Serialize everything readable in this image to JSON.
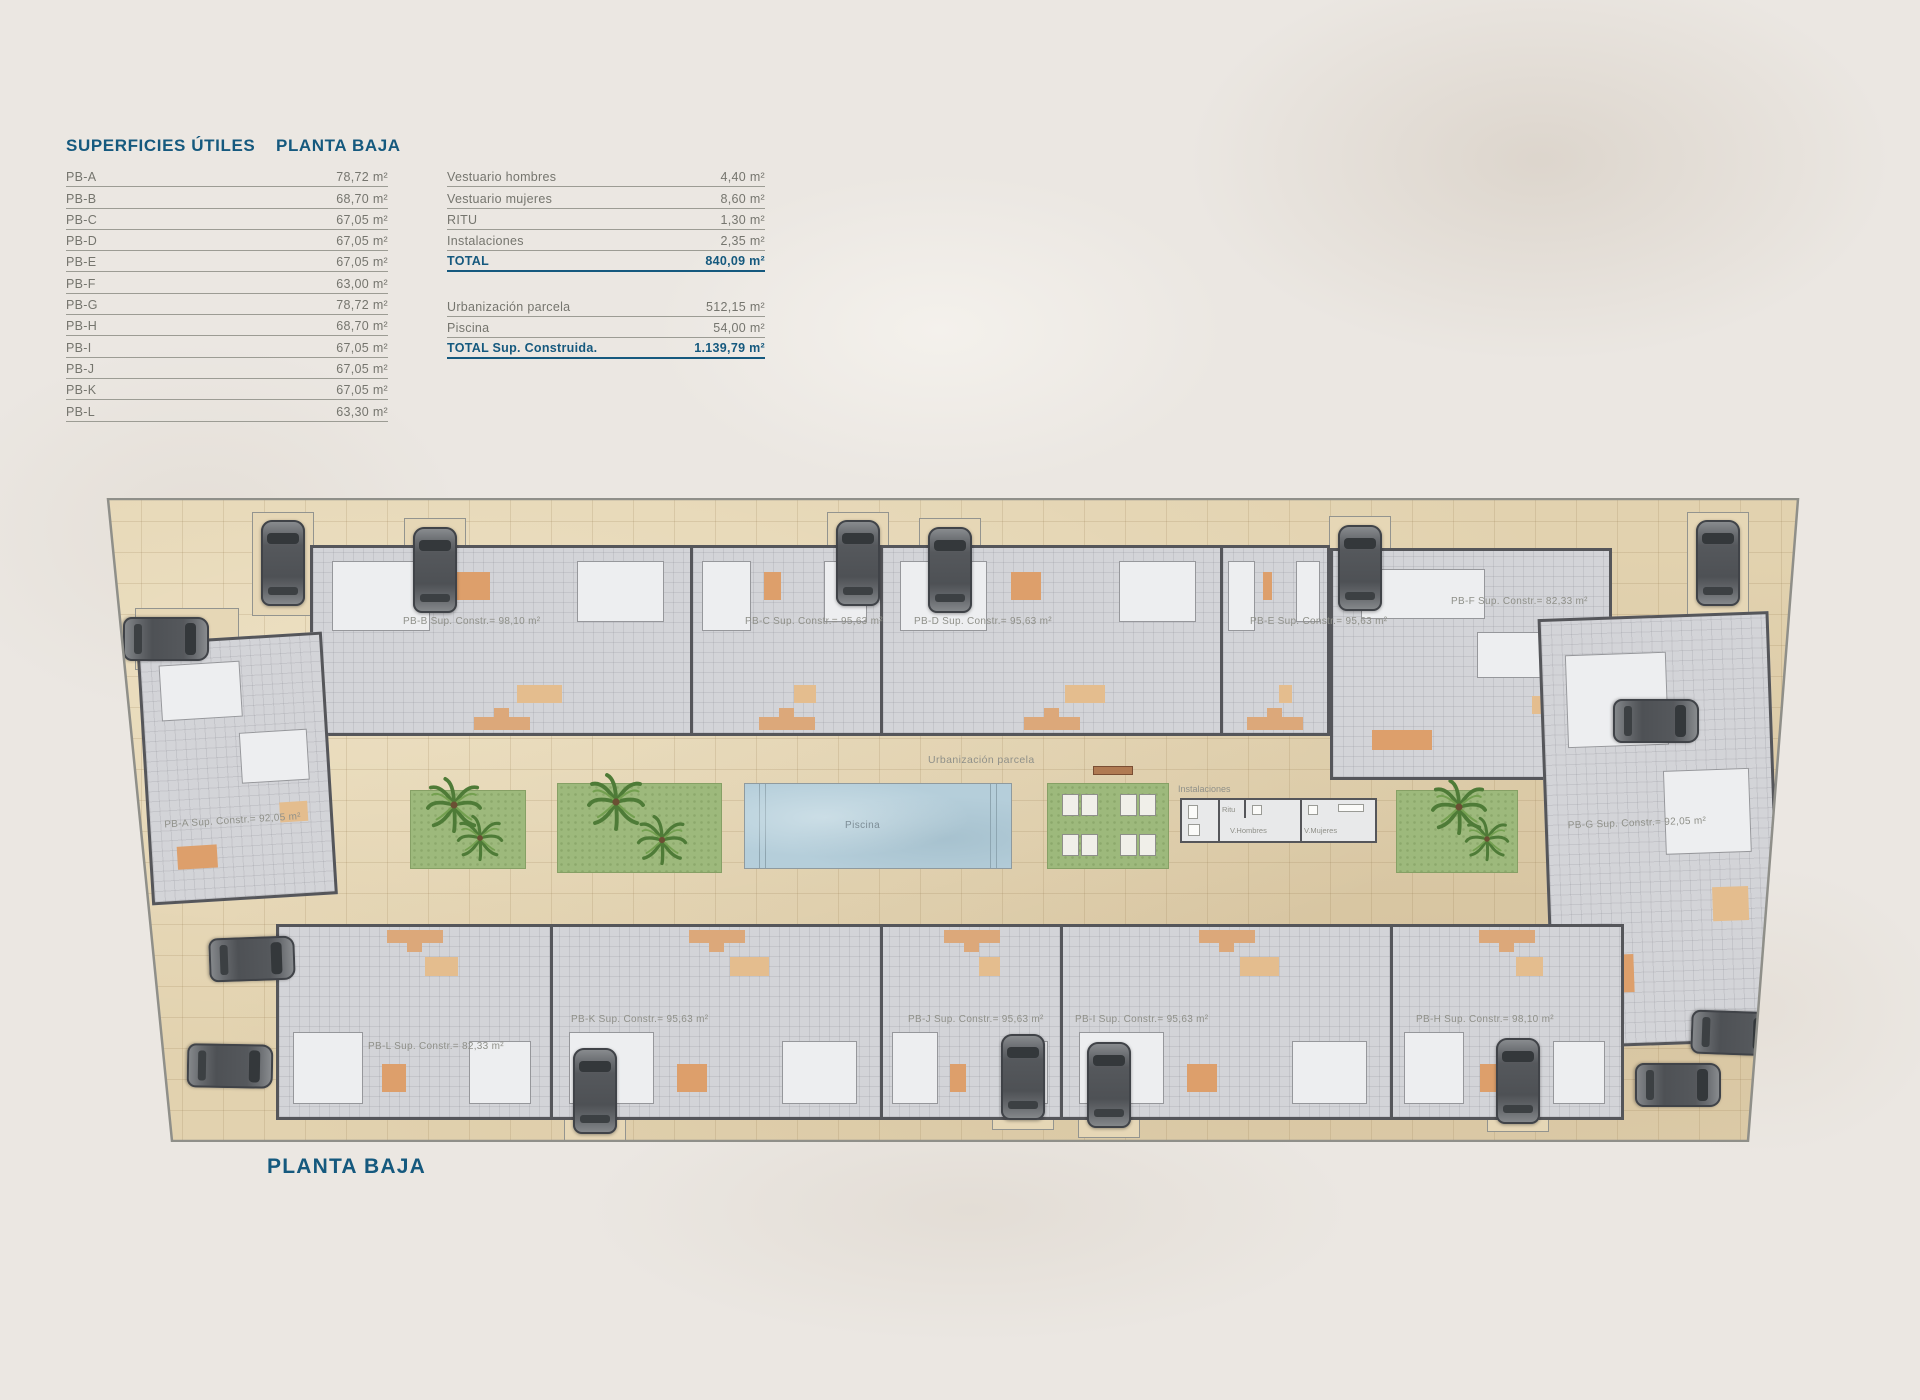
{
  "header": {
    "title": "SUPERFICIES ÚTILES",
    "subtitle": "PLANTA BAJA"
  },
  "areas_table": {
    "rows": [
      {
        "label": "PB-A",
        "value": "78,72 m²"
      },
      {
        "label": "PB-B",
        "value": "68,70 m²"
      },
      {
        "label": "PB-C",
        "value": "67,05 m²"
      },
      {
        "label": "PB-D",
        "value": "67,05 m²"
      },
      {
        "label": "PB-E",
        "value": "67,05 m²"
      },
      {
        "label": "PB-F",
        "value": "63,00 m²"
      },
      {
        "label": "PB-G",
        "value": "78,72 m²"
      },
      {
        "label": "PB-H",
        "value": "68,70 m²"
      },
      {
        "label": "PB-I",
        "value": "67,05 m²"
      },
      {
        "label": "PB-J",
        "value": "67,05 m²"
      },
      {
        "label": "PB-K",
        "value": "67,05 m²"
      },
      {
        "label": "PB-L",
        "value": "63,30 m²"
      }
    ]
  },
  "summary_table": {
    "rows": [
      {
        "label": "Vestuario hombres",
        "value": "4,40 m²"
      },
      {
        "label": "Vestuario mujeres",
        "value": "8,60 m²"
      },
      {
        "label": "RITU",
        "value": "1,30 m²"
      },
      {
        "label": "Instalaciones",
        "value": "2,35 m²"
      }
    ],
    "total": {
      "label": "TOTAL",
      "value": "840,09 m²"
    },
    "rows2": [
      {
        "label": "Urbanización parcela",
        "value": "512,15 m²"
      },
      {
        "label": "Piscina",
        "value": "54,00 m²"
      }
    ],
    "total2": {
      "label": "TOTAL Sup. Construida.",
      "value": "1.139,79 m²"
    }
  },
  "plan": {
    "units_top": [
      "PB-B Sup. Constr.= 98,10 m²",
      "PB-C Sup. Constr.= 95,63 m²",
      "PB-D Sup. Constr.= 95,63 m²",
      "PB-E Sup. Constr.= 95,63 m²"
    ],
    "unit_f": "PB-F Sup. Constr.= 82,33 m²",
    "unit_a": "PB-A Sup. Constr.= 92,05 m²",
    "unit_g": "PB-G Sup. Constr.= 92,05 m²",
    "units_bottom": [
      "PB-L Sup. Constr.= 82,33 m²",
      "PB-K Sup. Constr.= 95,63 m²",
      "PB-J Sup. Constr.= 95,63 m²",
      "PB-I Sup. Constr.= 95,63 m²",
      "PB-H Sup. Constr.= 98,10 m²"
    ],
    "labels": {
      "urbanizacion": "Urbanización parcela",
      "piscina": "Piscina",
      "instalaciones": "Instalaciones",
      "ritu": "Ritu",
      "vestuario_hombres": "V.Hombres",
      "vestuario_mujeres": "V.Mujeres"
    }
  },
  "footer": {
    "title": "PLANTA BAJA"
  },
  "colors": {
    "accent": "#15597e",
    "text_gray": "#75756e",
    "paving": "#e2d2af",
    "pool": "#b5ceda",
    "garden": "#9db97c"
  }
}
